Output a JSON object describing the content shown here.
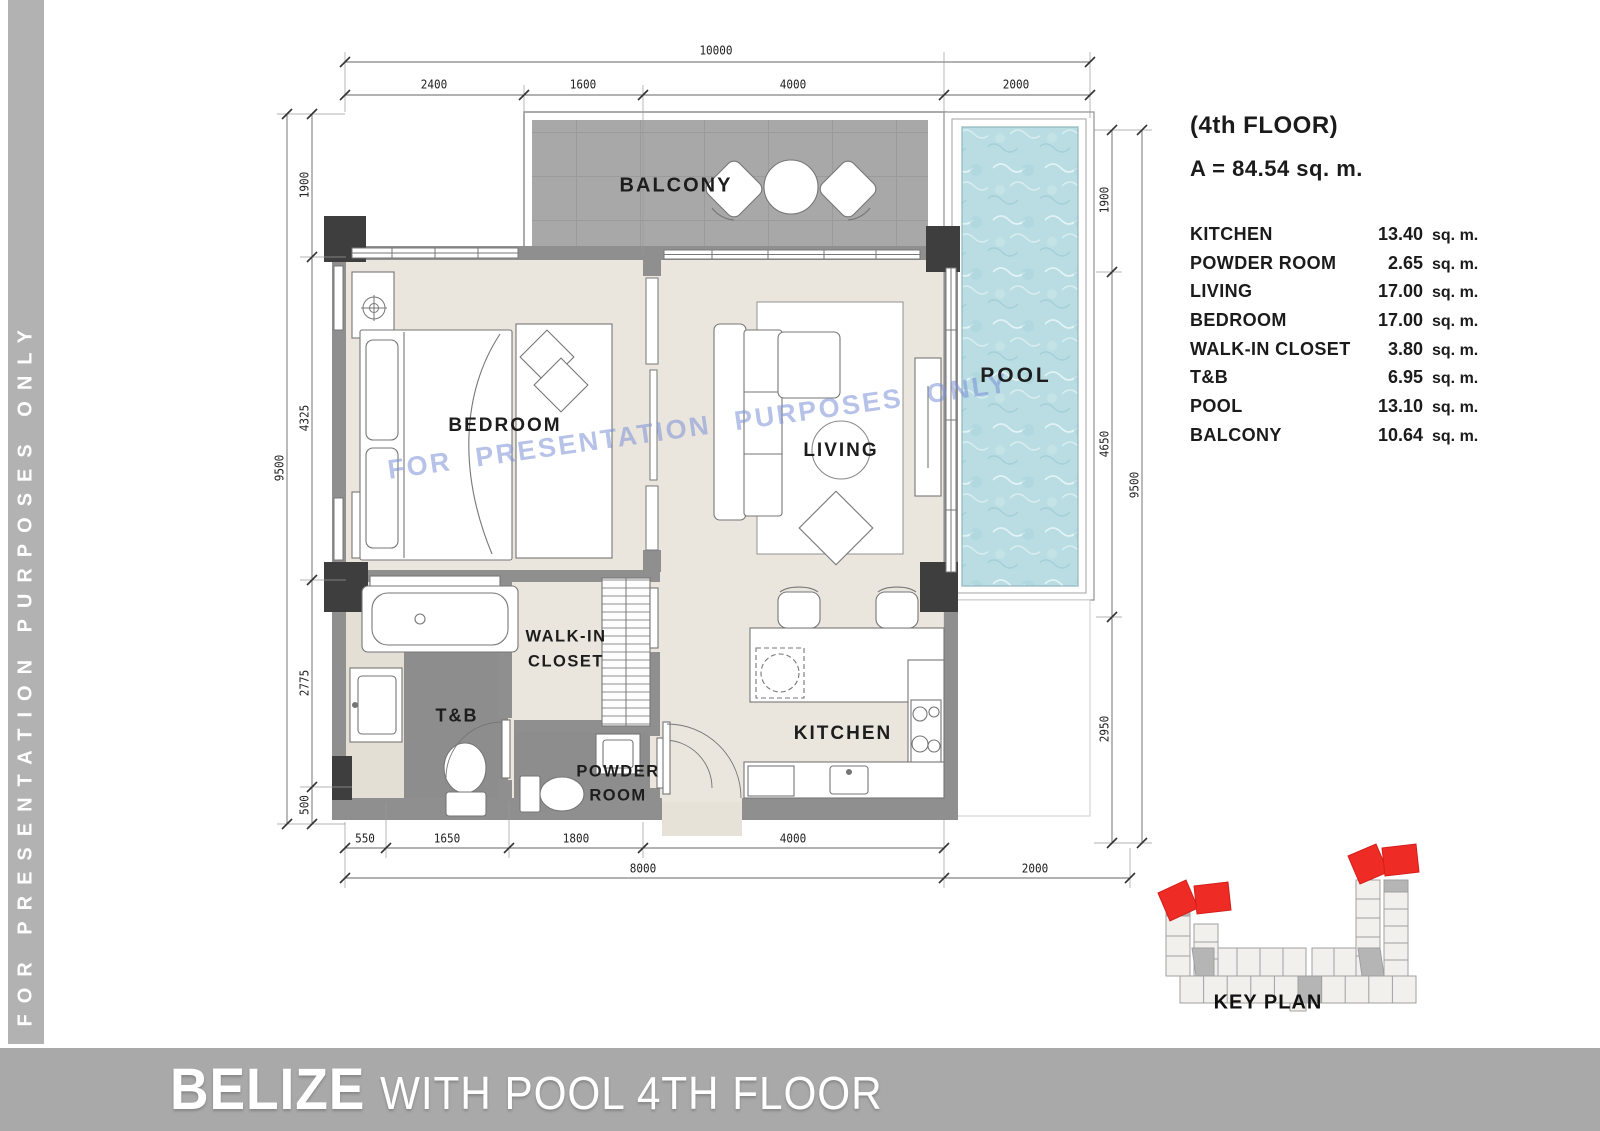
{
  "sidebar": {
    "text": "FOR PRESENTATION PURPOSES ONLY"
  },
  "watermark": {
    "text": "FOR PRESENTATION PURPOSES ONLY"
  },
  "info_panel": {
    "floor_label": "(4th FLOOR)",
    "total_area": "A = 84.54 sq. m.",
    "rooms": [
      {
        "name": "KITCHEN",
        "area": "13.40",
        "unit": "sq. m."
      },
      {
        "name": "POWDER ROOM",
        "area": "2.65",
        "unit": "sq. m."
      },
      {
        "name": "LIVING",
        "area": "17.00",
        "unit": "sq. m."
      },
      {
        "name": "BEDROOM",
        "area": "17.00",
        "unit": "sq. m."
      },
      {
        "name": "WALK-IN CLOSET",
        "area": "3.80",
        "unit": "sq. m."
      },
      {
        "name": "T&B",
        "area": "6.95",
        "unit": "sq. m."
      },
      {
        "name": "POOL",
        "area": "13.10",
        "unit": "sq. m."
      },
      {
        "name": "BALCONY",
        "area": "10.64",
        "unit": "sq. m."
      }
    ]
  },
  "plan_labels": {
    "balcony": "BALCONY",
    "bedroom": "BEDROOM",
    "living": "LIVING",
    "pool": "POOL",
    "walk_in_line1": "WALK-IN",
    "walk_in_line2": "CLOSET",
    "tb": "T&B",
    "powder_line1": "POWDER",
    "powder_line2": "ROOM",
    "kitchen": "KITCHEN"
  },
  "dimensions": {
    "top": {
      "total": "10000",
      "segments": [
        "2400",
        "1600",
        "4000",
        "2000"
      ]
    },
    "left": {
      "total": "9500",
      "segments": [
        "1900",
        "4325",
        "2775",
        "500"
      ]
    },
    "right": {
      "total": "9500",
      "segments": [
        "1900",
        "4650",
        "2950"
      ]
    },
    "bottom": {
      "segments": [
        "550",
        "1650",
        "1800",
        "4000"
      ],
      "totals": [
        "8000",
        "2000"
      ]
    }
  },
  "key_plan": {
    "label": "KEY PLAN"
  },
  "title_bar": {
    "name": "BELIZE",
    "subtitle": "WITH POOL 4TH FLOOR"
  },
  "colors": {
    "pool_water": "#b9dde2",
    "balcony_tile": "#a8a8a8",
    "wall": "#8f8f8f",
    "column": "#3e3e3e",
    "floor": "#eae6dd",
    "wet_floor": "#8d8d8d",
    "accent_red": "#ee2b24",
    "bar_gray": "#a9a9a9",
    "watermark_blue": "#7a8fd6"
  }
}
